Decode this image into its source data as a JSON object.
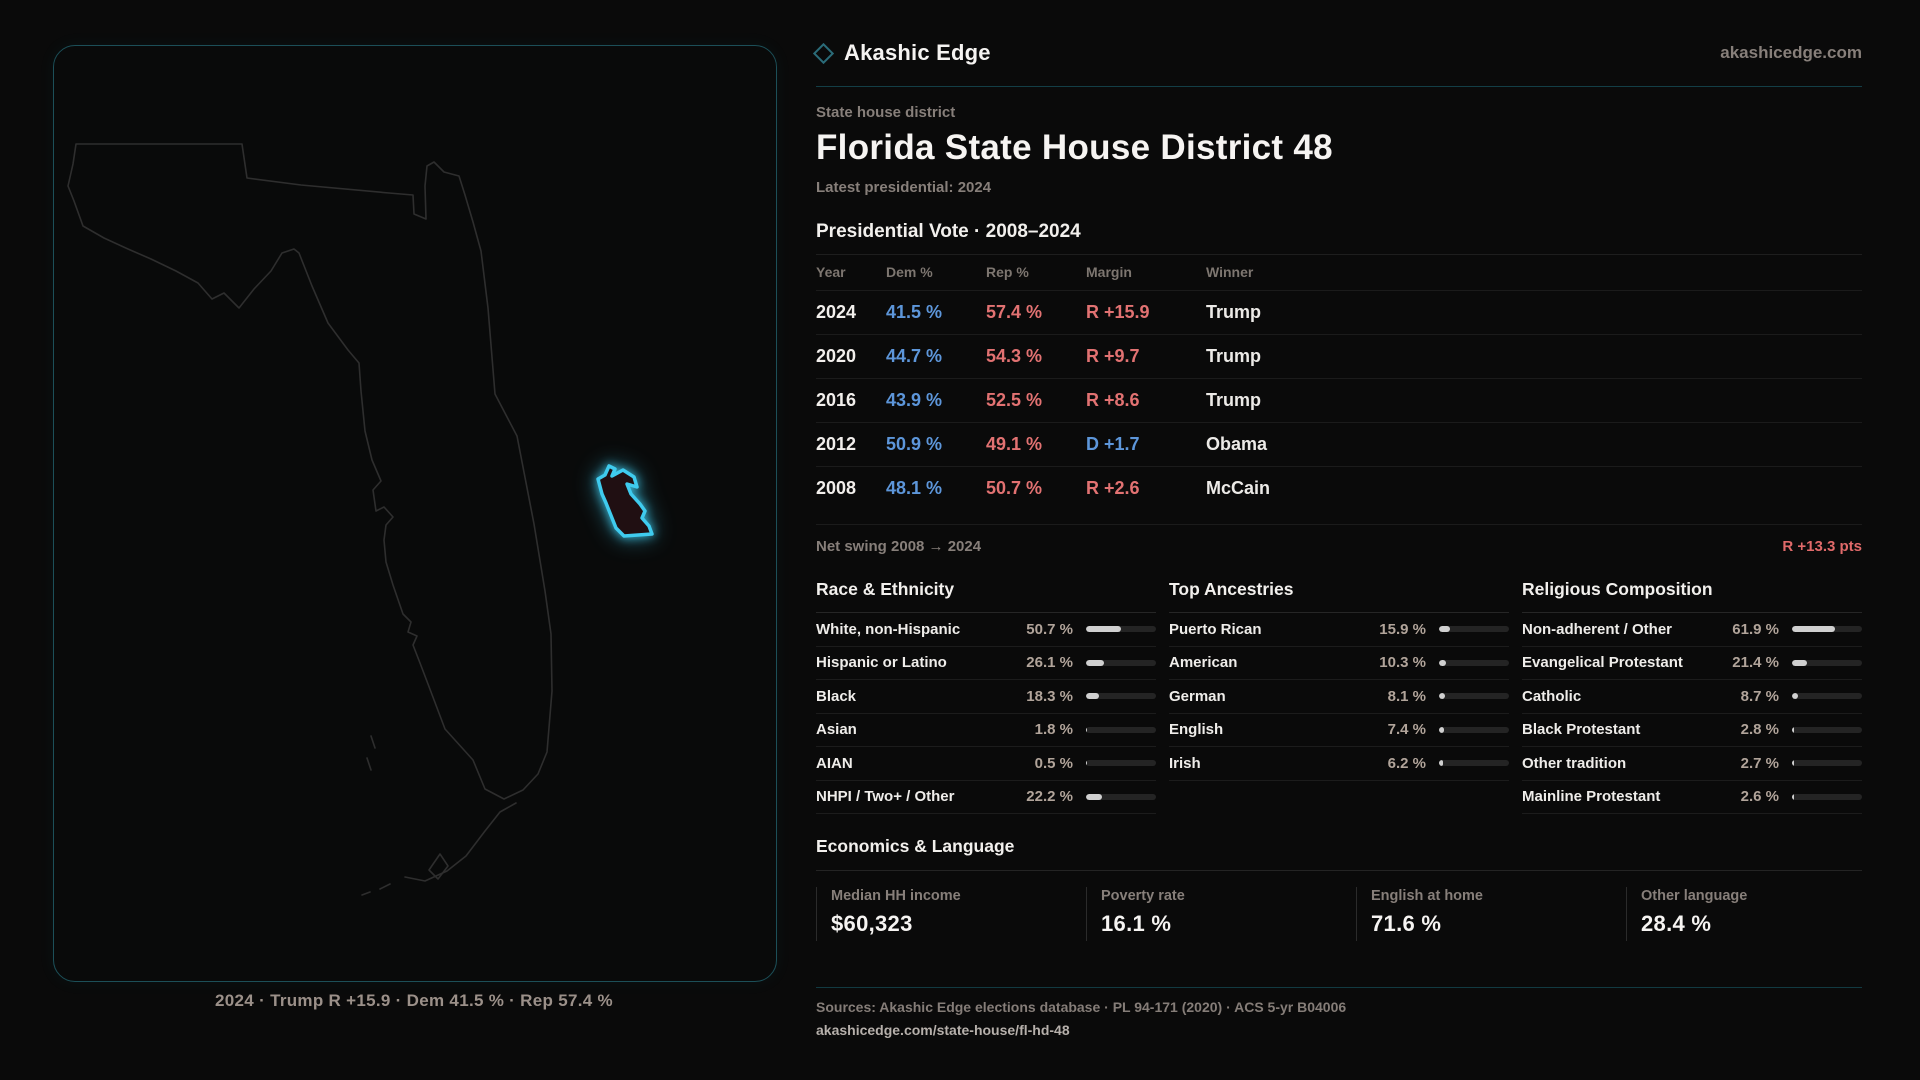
{
  "brand": {
    "name": "Akashic Edge",
    "domain": "akashicedge.com"
  },
  "header": {
    "kicker": "State house district",
    "title": "Florida State House District 48",
    "latest": "Latest presidential: 2024"
  },
  "table": {
    "title": "Presidential Vote · 2008–2024",
    "columns": [
      "Year",
      "Dem %",
      "Rep %",
      "Margin",
      "Winner"
    ],
    "rows": [
      {
        "year": "2024",
        "dem": "41.5 %",
        "rep": "57.4 %",
        "margin": "R +15.9",
        "margin_party": "R",
        "winner": "Trump"
      },
      {
        "year": "2020",
        "dem": "44.7 %",
        "rep": "54.3 %",
        "margin": "R +9.7",
        "margin_party": "R",
        "winner": "Trump"
      },
      {
        "year": "2016",
        "dem": "43.9 %",
        "rep": "52.5 %",
        "margin": "R +8.6",
        "margin_party": "R",
        "winner": "Trump"
      },
      {
        "year": "2012",
        "dem": "50.9 %",
        "rep": "49.1 %",
        "margin": "D +1.7",
        "margin_party": "D",
        "winner": "Obama"
      },
      {
        "year": "2008",
        "dem": "48.1 %",
        "rep": "50.7 %",
        "margin": "R +2.6",
        "margin_party": "R",
        "winner": "McCain"
      }
    ]
  },
  "net_swing": {
    "label": "Net swing 2008 → 2024",
    "value": "R +13.3 pts"
  },
  "chart_data": {
    "type": "bar",
    "title": "Demographic composition (percent, horizontal bars, range 0–100)",
    "series": [
      {
        "name": "Race & Ethnicity",
        "categories": [
          "White, non-Hispanic",
          "Hispanic or Latino",
          "Black",
          "Asian",
          "AIAN",
          "NHPI / Two+ / Other"
        ],
        "values": [
          50.7,
          26.1,
          18.3,
          1.8,
          0.5,
          22.2
        ]
      },
      {
        "name": "Top Ancestries",
        "categories": [
          "Puerto Rican",
          "American",
          "German",
          "English",
          "Irish"
        ],
        "values": [
          15.9,
          10.3,
          8.1,
          7.4,
          6.2
        ]
      },
      {
        "name": "Religious Composition",
        "categories": [
          "Non-adherent / Other",
          "Evangelical Protestant",
          "Catholic",
          "Black Protestant",
          "Other tradition",
          "Mainline Protestant"
        ],
        "values": [
          61.9,
          21.4,
          8.7,
          2.8,
          2.7,
          2.6
        ]
      }
    ]
  },
  "demographics": [
    {
      "title": "Race & Ethnicity",
      "rows": [
        {
          "label": "White, non-Hispanic",
          "value": "50.7 %",
          "pct": 50.7
        },
        {
          "label": "Hispanic or Latino",
          "value": "26.1 %",
          "pct": 26.1
        },
        {
          "label": "Black",
          "value": "18.3 %",
          "pct": 18.3
        },
        {
          "label": "Asian",
          "value": "1.8 %",
          "pct": 1.8
        },
        {
          "label": "AIAN",
          "value": "0.5 %",
          "pct": 0.5
        },
        {
          "label": "NHPI / Two+ / Other",
          "value": "22.2 %",
          "pct": 22.2
        }
      ]
    },
    {
      "title": "Top Ancestries",
      "rows": [
        {
          "label": "Puerto Rican",
          "value": "15.9 %",
          "pct": 15.9
        },
        {
          "label": "American",
          "value": "10.3 %",
          "pct": 10.3
        },
        {
          "label": "German",
          "value": "8.1 %",
          "pct": 8.1
        },
        {
          "label": "English",
          "value": "7.4 %",
          "pct": 7.4
        },
        {
          "label": "Irish",
          "value": "6.2 %",
          "pct": 6.2
        }
      ]
    },
    {
      "title": "Religious Composition",
      "rows": [
        {
          "label": "Non-adherent / Other",
          "value": "61.9 %",
          "pct": 61.9
        },
        {
          "label": "Evangelical Protestant",
          "value": "21.4 %",
          "pct": 21.4
        },
        {
          "label": "Catholic",
          "value": "8.7 %",
          "pct": 8.7
        },
        {
          "label": "Black Protestant",
          "value": "2.8 %",
          "pct": 2.8
        },
        {
          "label": "Other tradition",
          "value": "2.7 %",
          "pct": 2.7
        },
        {
          "label": "Mainline Protestant",
          "value": "2.6 %",
          "pct": 2.6
        }
      ]
    }
  ],
  "economics": {
    "title": "Economics & Language",
    "stats": [
      {
        "label": "Median HH income",
        "value": "$60,323"
      },
      {
        "label": "Poverty rate",
        "value": "16.1 %"
      },
      {
        "label": "English at home",
        "value": "71.6 %"
      },
      {
        "label": "Other language",
        "value": "28.4 %"
      }
    ]
  },
  "map": {
    "caption": "2024 · Trump R +15.9 · Dem 41.5 % · Rep 57.4 %"
  },
  "footer": {
    "sources": "Sources: Akashic Edge elections database · PL 94-171 (2020) · ACS 5-yr B04006",
    "permalink": "akashicedge.com/state-house/fl-hd-48"
  },
  "colors": {
    "dem": "#5d96da",
    "rep": "#e27272",
    "accent_cyan": "#3fcbee",
    "panel_border": "#1c4f58",
    "muted_text": "#877f7a",
    "bar_fill": "#d0d0d0"
  }
}
